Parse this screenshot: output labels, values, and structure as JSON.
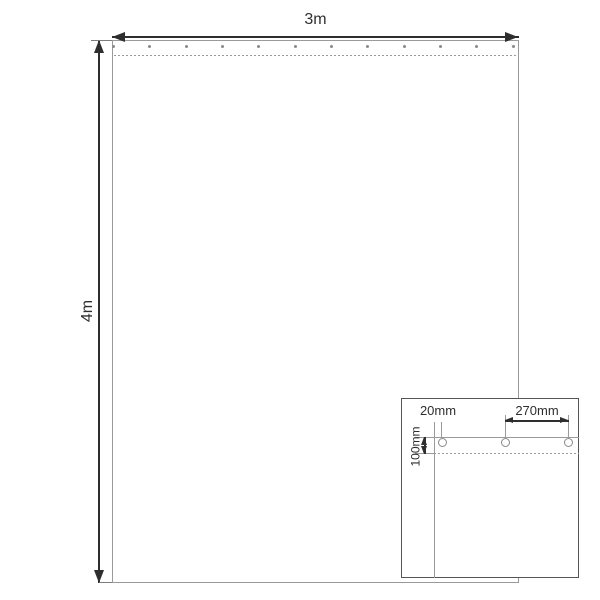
{
  "main_view": {
    "width_label": "3m",
    "height_label": "4m",
    "eyelet_count": 12
  },
  "detail_view": {
    "edge_offset_label": "20mm",
    "eyelet_spacing_label": "270mm",
    "hem_depth_label": "100mm",
    "eyelet_count": 3
  },
  "colors": {
    "dimension": "#2e2e2e",
    "outline": "#9a9a9a",
    "eyelet": "#8a8a8a",
    "inset_border": "#555555",
    "background": "#ffffff"
  }
}
